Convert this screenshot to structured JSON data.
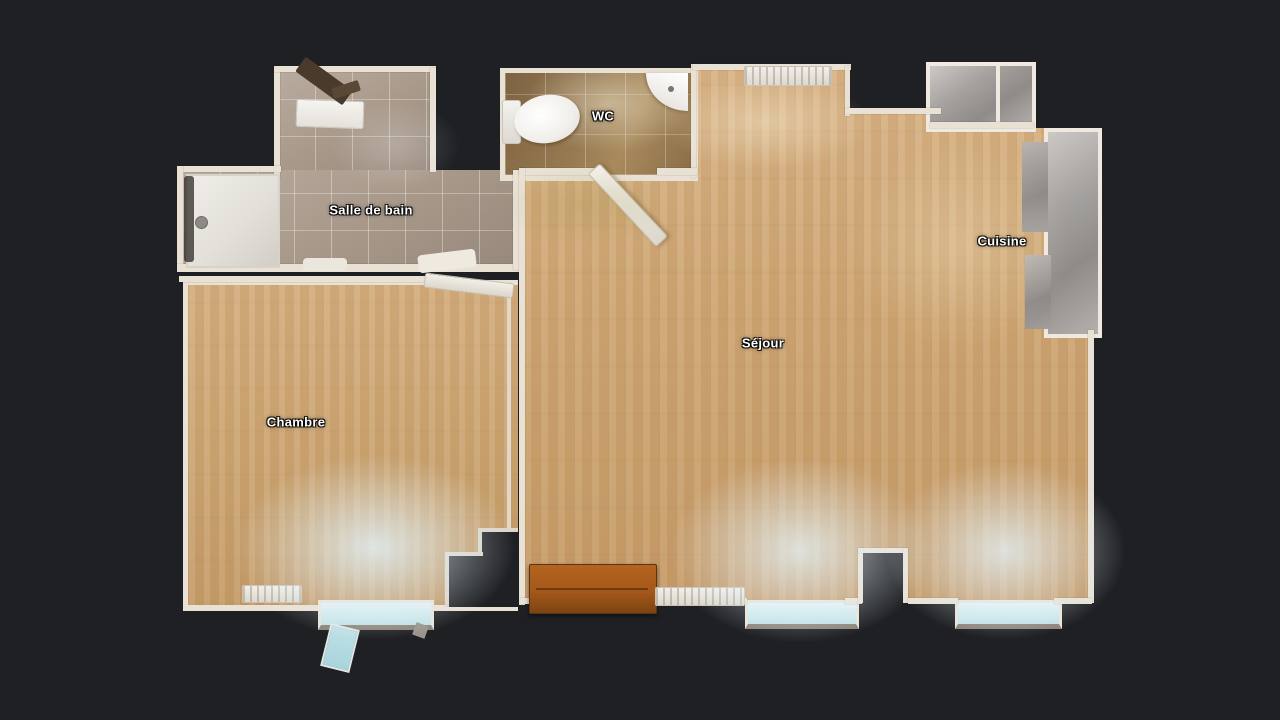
{
  "app": {
    "view": "floorplan-top-view",
    "background": "#1f2023"
  },
  "rooms": [
    {
      "id": "salle_de_bain",
      "label": "Salle de bain"
    },
    {
      "id": "wc",
      "label": "WC"
    },
    {
      "id": "chambre",
      "label": "Chambre"
    },
    {
      "id": "sejour",
      "label": "Séjour"
    },
    {
      "id": "cuisine",
      "label": "Cuisine"
    }
  ],
  "colors": {
    "background": "#1f2023",
    "wood_floor": "#cea673",
    "bath_tile": "#a79889",
    "wc_tile": "#977a51",
    "walls": "#e9e1d4",
    "window_glass": "#cfe9ec",
    "entry_furniture": "#a85a1e",
    "appliance_gray": "#a5a2a0",
    "label_text": "#ffffff"
  }
}
